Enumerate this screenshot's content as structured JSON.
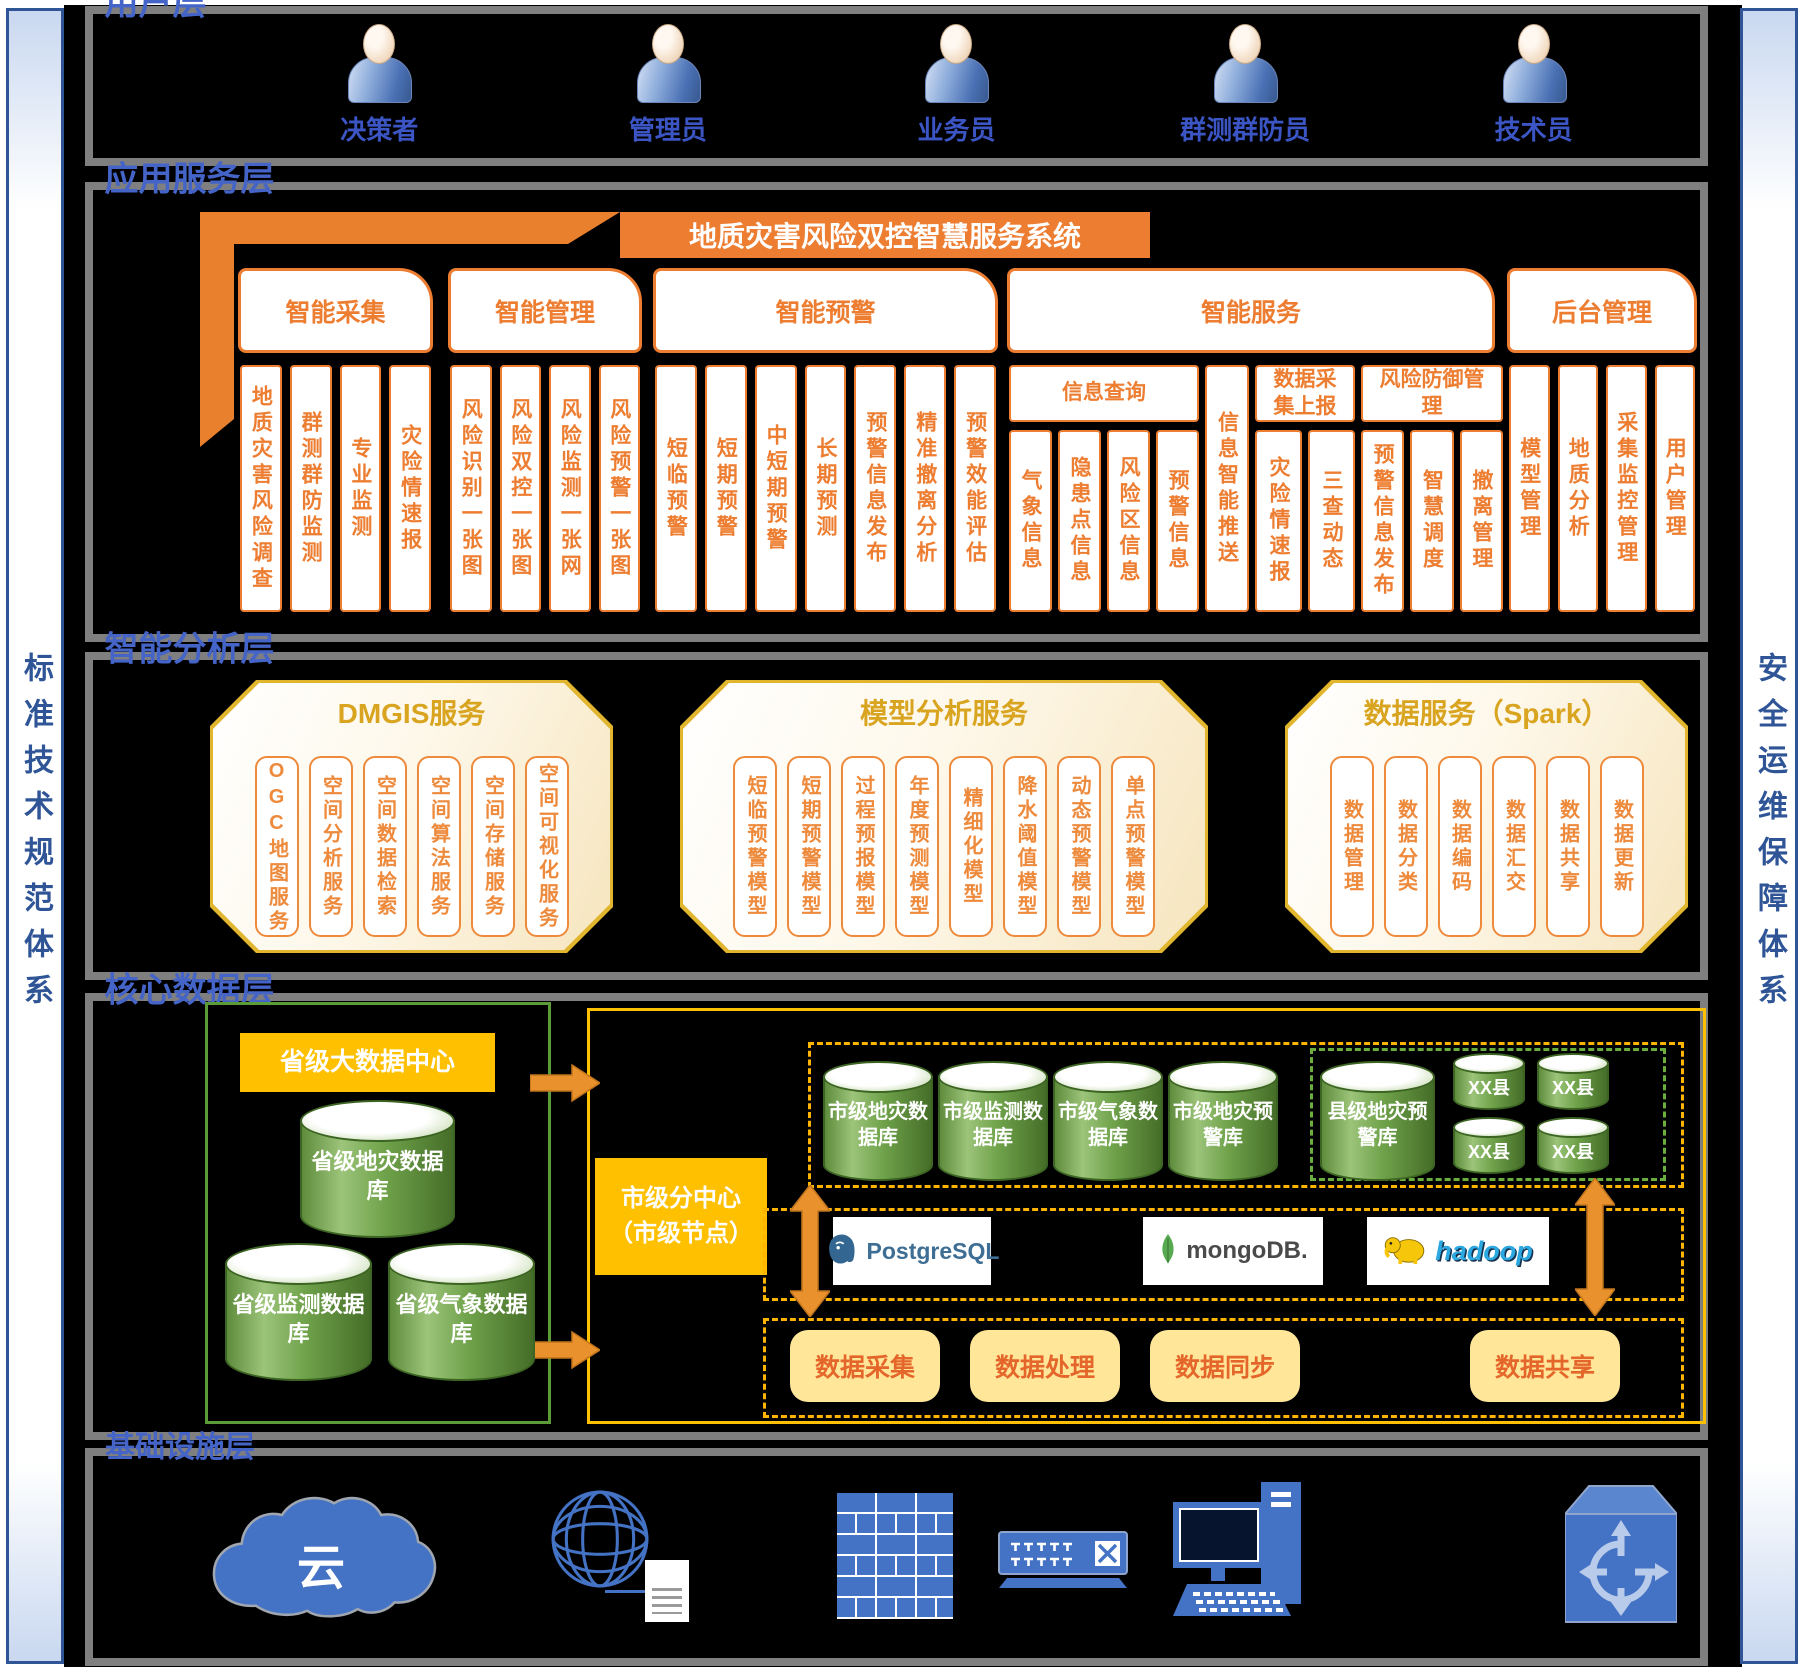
{
  "sidebars": {
    "left": "标准技术规范体系",
    "right": "安全运维保障体系"
  },
  "user_layer": {
    "label": "用户层",
    "users": [
      "决策者",
      "管理员",
      "业务员",
      "群测群防员",
      "技术员"
    ]
  },
  "app_layer": {
    "label": "应用服务层",
    "title": "地质灾害风险双控智慧服务系统",
    "groups": [
      {
        "name": "智能采集",
        "items": [
          "地质灾害风险调查",
          "群测群防监测",
          "专业监测",
          "灾险情速报"
        ]
      },
      {
        "name": "智能管理",
        "items": [
          "风险识别一张图",
          "风险双控一张图",
          "风险监测一张网",
          "风险预警一张图"
        ]
      },
      {
        "name": "智能预警",
        "items": [
          "短临预警",
          "短期预警",
          "中短期预警",
          "长期预测",
          "预警信息发布",
          "精准撤离分析",
          "预警效能评估"
        ]
      },
      {
        "name": "智能服务",
        "subgroups": [
          {
            "name": "信息查询",
            "items": [
              "气象信息",
              "隐患点信息",
              "风险区信息",
              "预警信息"
            ]
          },
          {
            "name": "",
            "items": [
              "信息智能推送"
            ]
          },
          {
            "name": "数据采集上报",
            "items": [
              "灾险情速报",
              "三查动态"
            ]
          },
          {
            "name": "风险防御管理",
            "items": [
              "预警信息发布",
              "智慧调度",
              "撤离管理"
            ]
          }
        ]
      },
      {
        "name": "后台管理",
        "items": [
          "模型管理",
          "地质分析",
          "采集监控管理",
          "用户管理"
        ]
      }
    ]
  },
  "analysis_layer": {
    "label": "智能分析层",
    "panels": [
      {
        "title": "DMGIS服务",
        "items": [
          "OGC地图服务",
          "空间分析服务",
          "空间数据检索",
          "空间算法服务",
          "空间存储服务",
          "空间可视化服务"
        ]
      },
      {
        "title": "模型分析服务",
        "items": [
          "短临预警模型",
          "短期预警模型",
          "过程预报模型",
          "年度预测模型",
          "精细化模型",
          "降水阈值模型",
          "动态预警模型",
          "单点预警模型"
        ]
      },
      {
        "title": "数据服务（Spark）",
        "items": [
          "数据管理",
          "数据分类",
          "数据编码",
          "数据汇交",
          "数据共享",
          "数据更新"
        ]
      }
    ]
  },
  "data_layer": {
    "label": "核心数据层",
    "province_center": "省级大数据中心",
    "province_dbs": [
      "省级地灾数据库",
      "省级监测数据库",
      "省级气象数据库"
    ],
    "city_center": "市级分中心（市级节点）",
    "city_dbs": [
      "市级地灾数据库",
      "市级监测数据库",
      "市级气象数据库",
      "市级地灾预警库"
    ],
    "county_db": "县级地灾预警库",
    "county_nodes": [
      "XX县",
      "XX县",
      "XX县",
      "XX县"
    ],
    "middleware": [
      "PostgreSQL",
      "mongoDB.",
      "hadoop"
    ],
    "processes": [
      "数据采集",
      "数据处理",
      "数据同步",
      "数据共享"
    ]
  },
  "infra_layer": {
    "label": "基础设施层",
    "cloud_text": "云",
    "icons": [
      "cloud",
      "globe",
      "firewall",
      "switch",
      "workstation",
      "router-cube"
    ]
  },
  "colors": {
    "accent_orange": "#ED7D31",
    "ribbon_orange": "#E8802E",
    "gold_border": "#E2B52F",
    "gold_text": "#D9A420",
    "layer_blue": "#4464C8",
    "icon_blue": "#4472C4",
    "db_green": "#6FA24A",
    "green_border": "#5B9B38",
    "yellow": "#FFC000",
    "light_yellow": "#FFE699",
    "gray_border": "#7F7F7F"
  }
}
